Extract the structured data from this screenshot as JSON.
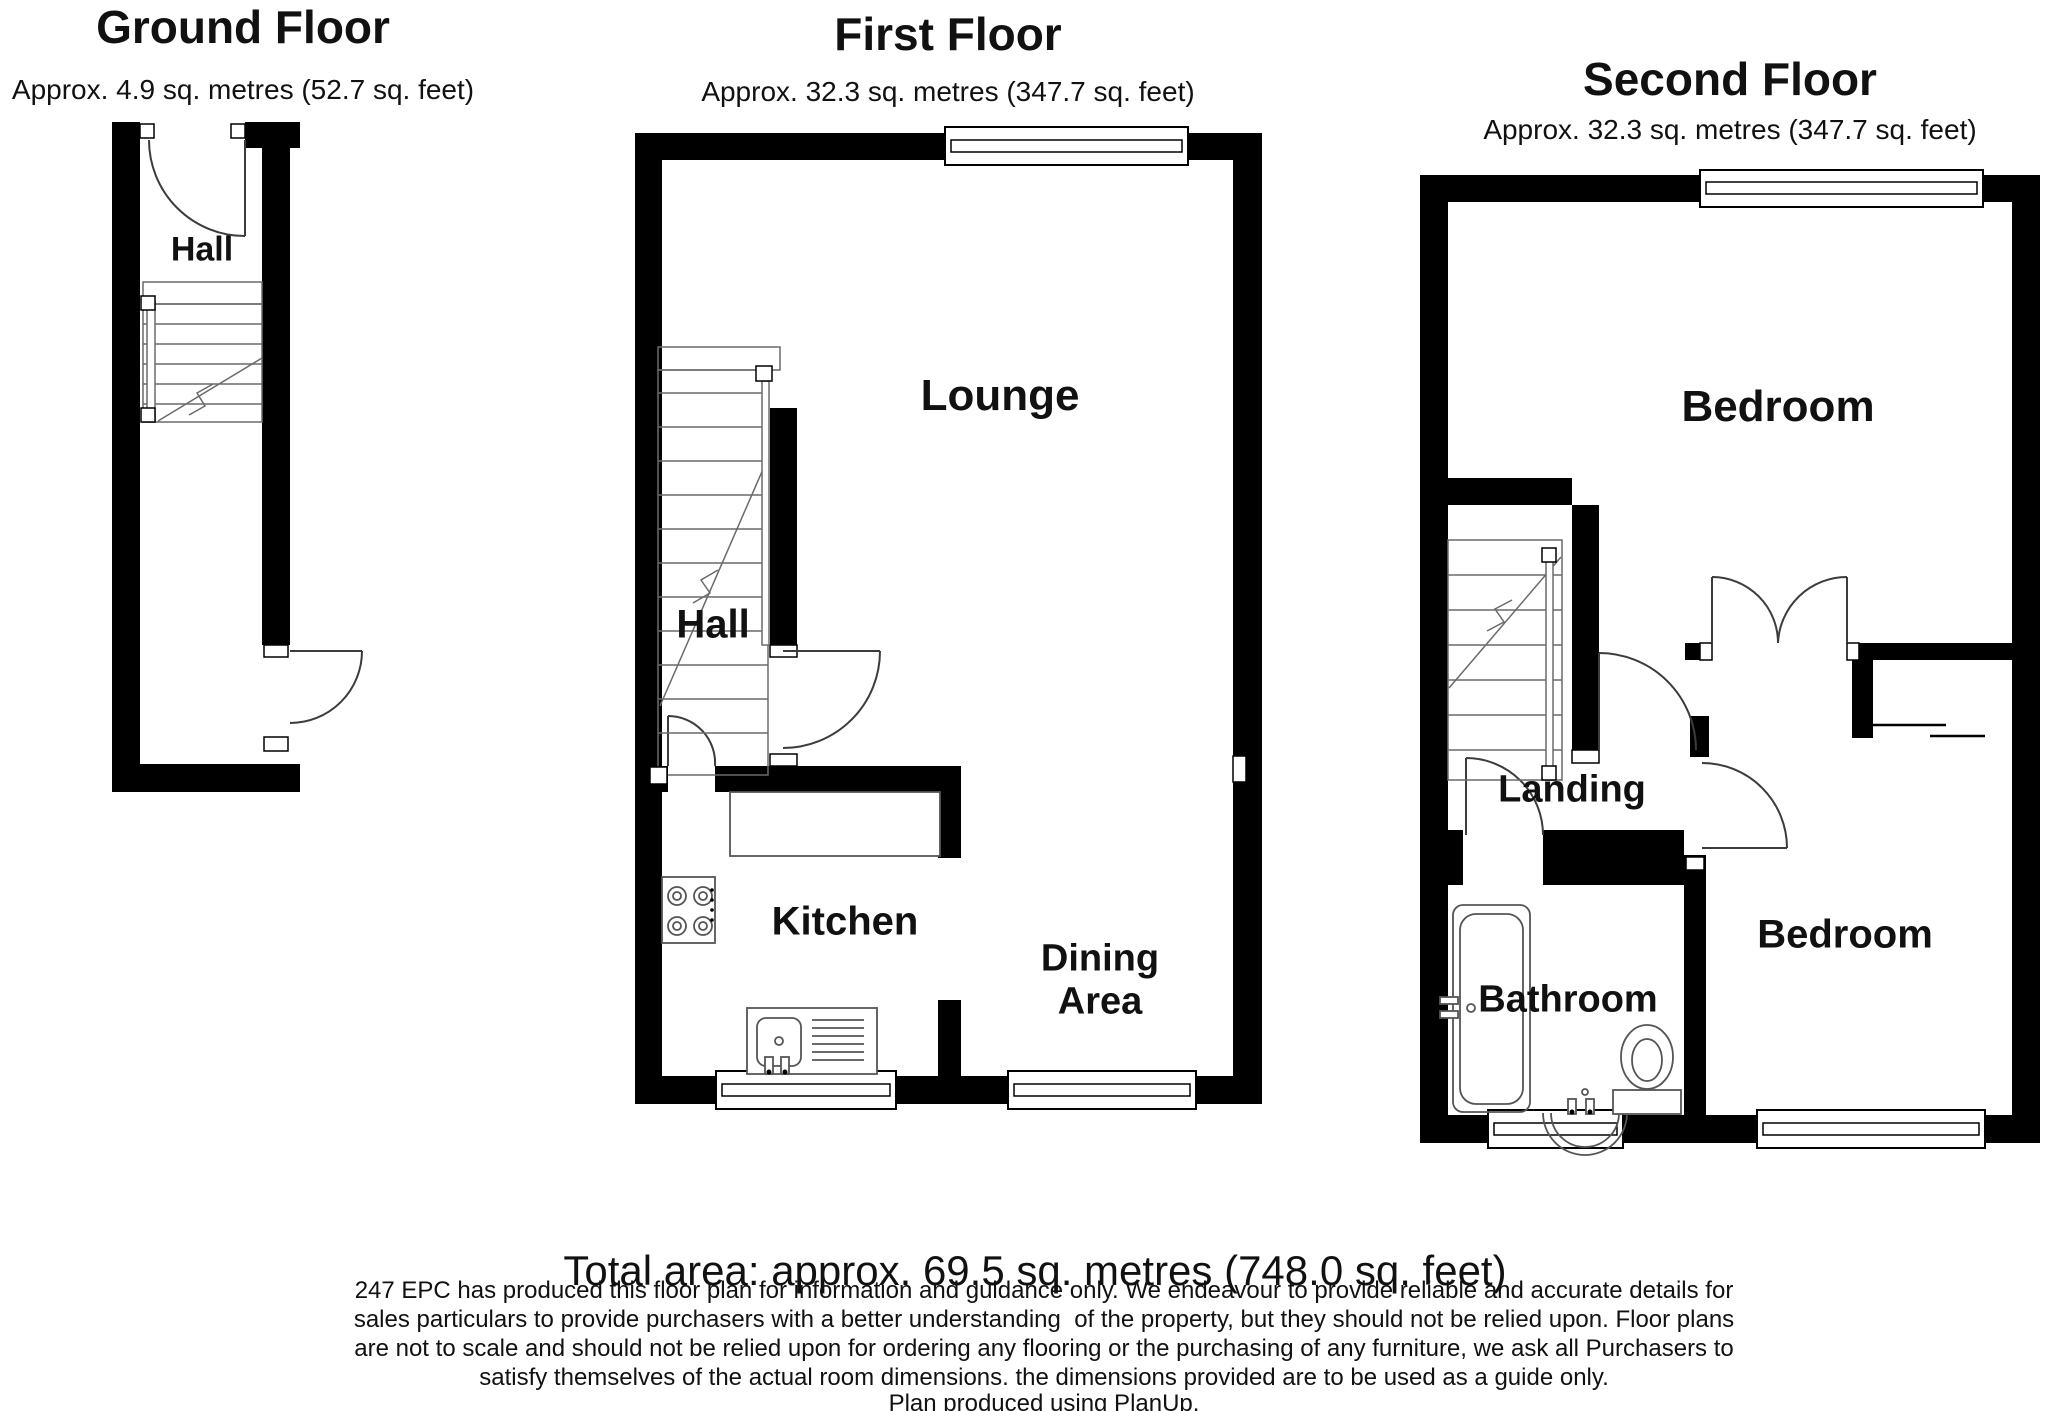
{
  "page": {
    "background": "#ffffff",
    "wall_color": "#000000",
    "line_color": "#555555"
  },
  "floors": [
    {
      "title": "Ground Floor",
      "subtitle": "Approx. 4.9 sq. metres (52.7 sq. feet)",
      "rooms": {
        "hall": "Hall"
      }
    },
    {
      "title": "First Floor",
      "subtitle": "Approx. 32.3 sq. metres (347.7 sq. feet)",
      "rooms": {
        "lounge": "Lounge",
        "hall": "Hall",
        "kitchen": "Kitchen",
        "dining": "Dining Area"
      }
    },
    {
      "title": "Second Floor",
      "subtitle": "Approx. 32.3 sq. metres (347.7 sq. feet)",
      "rooms": {
        "bedroom_top": "Bedroom",
        "landing": "Landing",
        "bathroom": "Bathroom",
        "bedroom_bottom": "Bedroom"
      }
    }
  ],
  "footer": {
    "total_area": "Total area: approx. 69.5 sq. metres (748.0 sq. feet)",
    "disclaimer_lines": [
      "247 EPC has produced this floor plan for information and guidance only. We endeavour to provide reliable and accurate details for",
      "sales particulars to provide purchasers with a better understanding  of the property, but they should not be relied upon. Floor plans",
      "are not to scale and should not be relied upon for ordering any flooring or the purchasing of any furniture, we ask all Purchasers to",
      "satisfy themselves of the actual room dimensions. the dimensions provided are to be used as a guide only."
    ],
    "credit": "Plan produced using PlanUp."
  }
}
